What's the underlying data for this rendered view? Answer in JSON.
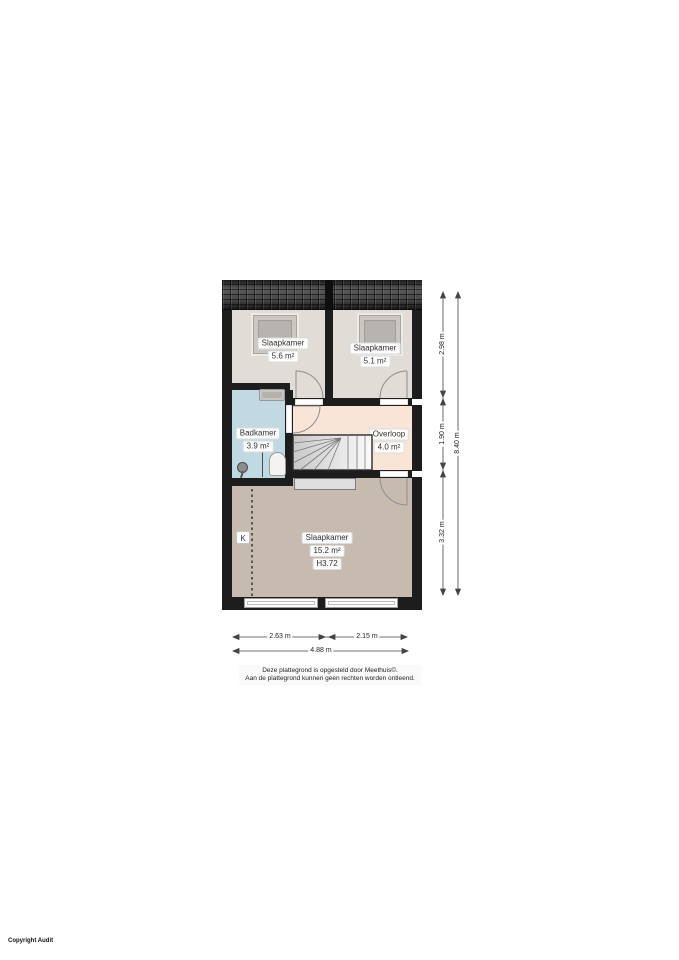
{
  "plan": {
    "rooms": {
      "bedroom_left": {
        "name": "Slaapkamer",
        "area": "5.6 m²"
      },
      "bedroom_right": {
        "name": "Slaapkamer",
        "area": "5.1 m²"
      },
      "bathroom": {
        "name": "Badkamer",
        "area": "3.9 m²"
      },
      "landing": {
        "name": "Overloop",
        "area": "4.0 m²"
      },
      "bedroom_main": {
        "name": "Slaapkamer",
        "area": "15.2 m²",
        "ceiling_height": "H3.72"
      },
      "knee_wall_marker": "K"
    },
    "dimensions": {
      "right_segments": [
        "2.98 m",
        "1.90 m",
        "3.32 m"
      ],
      "right_total": "8.40 m",
      "bottom_segments": [
        "2.63 m",
        "2.15 m"
      ],
      "bottom_total": "4.88 m"
    }
  },
  "footer": {
    "disclaimer_line1": "Deze plattegrond is opgesteld door Meethuis©.",
    "disclaimer_line2": "Aan de plattegrond kunnen geen rechten worden ontleend.",
    "copyright": "Copyright Audit"
  },
  "colors": {
    "wall": "#1d1d1d",
    "bedroom-floor": "#e1dcd5",
    "bathroom-floor": "#c0d9e3",
    "landing-floor": "#f9e5d7",
    "main-floor": "#c7bbb0",
    "label-text": "#333333"
  }
}
